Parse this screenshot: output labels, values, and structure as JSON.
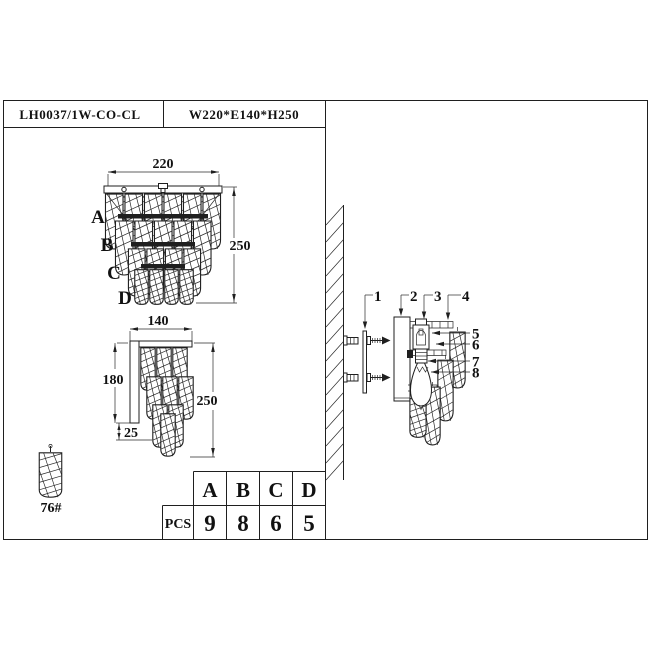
{
  "header": {
    "model": "LH0037/1W-CO-CL",
    "dimensions": "W220*E140*H250"
  },
  "front_view": {
    "width": "220",
    "height": "250",
    "tiers": [
      "A",
      "B",
      "C",
      "D"
    ]
  },
  "side_view": {
    "width": "140",
    "depth": "180",
    "height": "250",
    "inset": "25"
  },
  "crystal_part": {
    "label": "76#"
  },
  "parts_table": {
    "unit_label": "PCS",
    "columns": [
      "A",
      "B",
      "C",
      "D"
    ],
    "quantities": [
      "9",
      "8",
      "6",
      "5"
    ]
  },
  "installation": {
    "callouts": [
      "1",
      "2",
      "3",
      "4",
      "5",
      "6",
      "7",
      "8"
    ]
  },
  "colors": {
    "line": "#1f1f1f",
    "background": "#ffffff"
  }
}
